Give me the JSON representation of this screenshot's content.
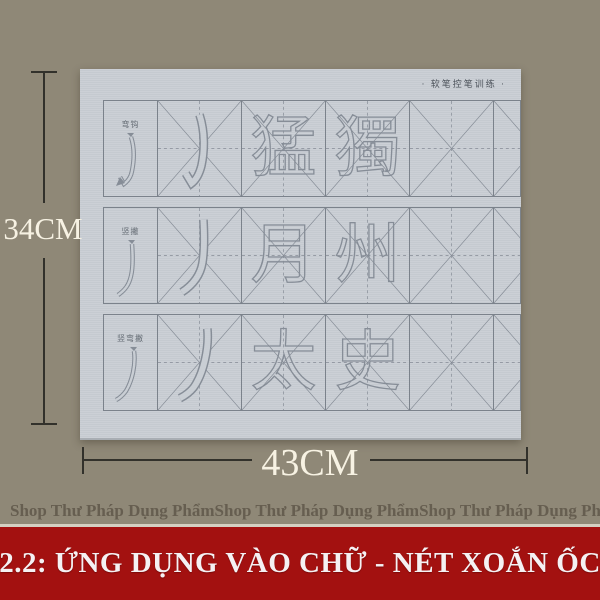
{
  "sheet": {
    "brand_text": "· 软笔控笔训练 ·",
    "rows": [
      {
        "stroke_label": "弯钩",
        "char1": "猛",
        "char2": "獨"
      },
      {
        "stroke_label": "竖撇",
        "char1": "月",
        "char2": "州"
      },
      {
        "stroke_label": "竖弯撇",
        "char1": "太",
        "char2": "史"
      }
    ]
  },
  "dimensions": {
    "height_label": "34CM",
    "width_label": "43CM"
  },
  "watermark": {
    "text": "Shop Thư Pháp Dụng Phẩm"
  },
  "banner": {
    "text": "2.2: ỨNG DỤNG VÀO CHỮ - NÉT XOẮN ỐC"
  },
  "colors": {
    "background": "#8f8877",
    "paper": "#c9ced4",
    "grid_line": "#7b828b",
    "banner_bg": "#a31110",
    "banner_text": "#f5f1f3",
    "dimension_text": "#f7f2e3",
    "watermark_text": "#665e50"
  }
}
